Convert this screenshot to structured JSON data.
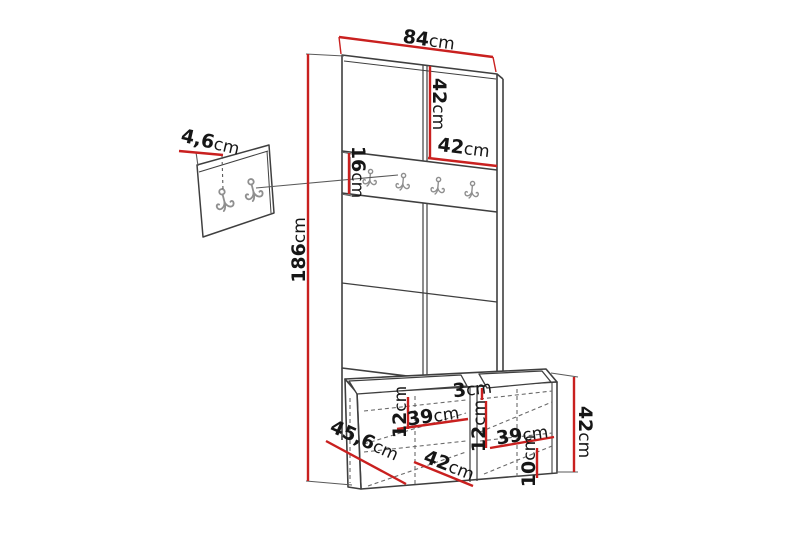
{
  "dims": {
    "panel_width": {
      "v": "84",
      "u": "cm"
    },
    "door_height": {
      "v": "42",
      "u": "cm"
    },
    "door_width": {
      "v": "42",
      "u": "cm"
    },
    "rail_height": {
      "v": "16",
      "u": "cm"
    },
    "total_height": {
      "v": "186",
      "u": "cm"
    },
    "wall_panel_depth": {
      "v": "4,6",
      "u": "cm"
    },
    "seat_gap": {
      "v": "3",
      "u": "cm"
    },
    "left_inner_height": {
      "v": "12",
      "u": "cm"
    },
    "left_shelf_width": {
      "v": "39",
      "u": "cm"
    },
    "mid_inner_height": {
      "v": "12",
      "u": "cm"
    },
    "right_shelf_width": {
      "v": "39",
      "u": "cm"
    },
    "bench_height": {
      "v": "42",
      "u": "cm"
    },
    "plinth_height": {
      "v": "10",
      "u": "cm"
    },
    "bench_depth": {
      "v": "45,6",
      "u": "cm"
    },
    "bench_section_width": {
      "v": "42",
      "u": "cm"
    }
  },
  "colors": {
    "dimension_red": "#c9201f",
    "outline": "#3f3f3f",
    "thin_line": "#5a5a5a",
    "dashed_line": "#6a6a6a",
    "hook_gray": "#8f8f8f",
    "text": "#161616",
    "background": "#ffffff"
  }
}
